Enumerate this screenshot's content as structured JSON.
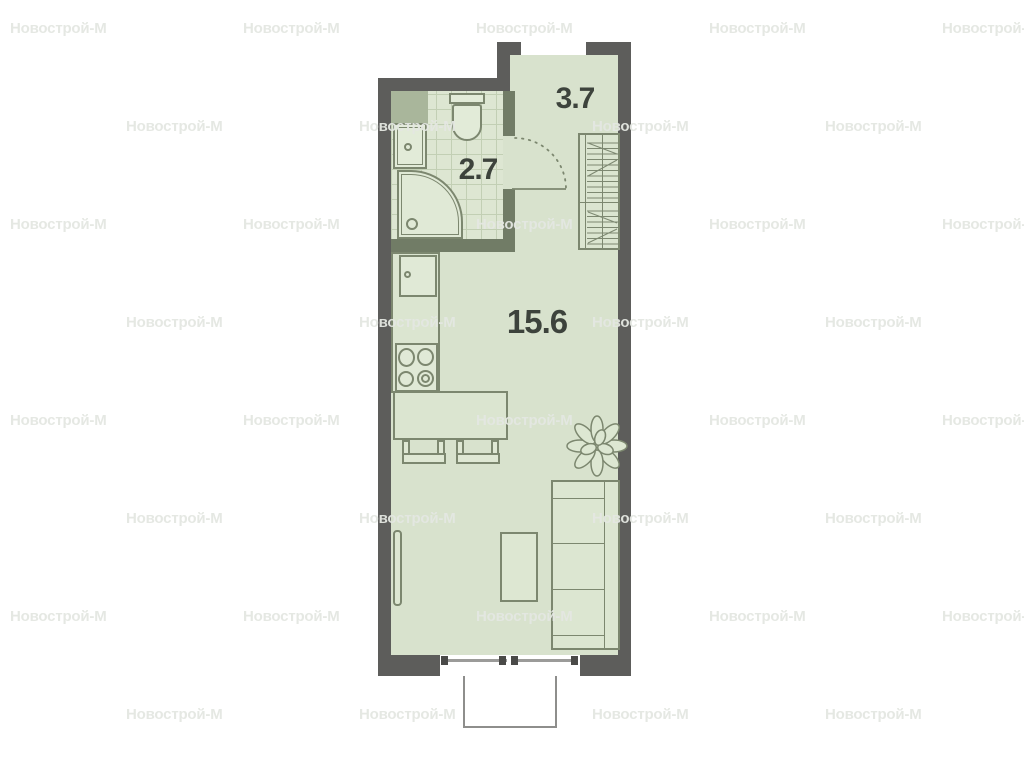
{
  "watermark": {
    "text": "Новострой-М"
  },
  "plan": {
    "rooms": [
      {
        "id": "entry-hall",
        "area_label": "3.7"
      },
      {
        "id": "bathroom",
        "area_label": "2.7"
      },
      {
        "id": "living-room",
        "area_label": "15.6"
      }
    ]
  },
  "colors": {
    "exterior_wall": "#5d5d5b",
    "partition_wall": "#717c66",
    "floor": "#d8e2cd",
    "tile_line": "#c2cfb4",
    "furniture_outline": "#7c876f",
    "label_text": "#3d433c",
    "watermark": "#e7eae4"
  }
}
